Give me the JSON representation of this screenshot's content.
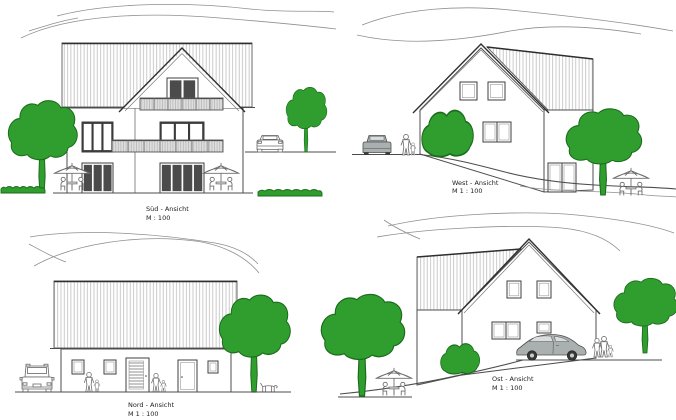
{
  "views": [
    {
      "id": "sued",
      "title": "Süd - Ansicht",
      "scale_label": "M : 100"
    },
    {
      "id": "west",
      "title": "West - Ansicht",
      "scale_label": "M 1 : 100"
    },
    {
      "id": "nord",
      "title": "Nord - Ansicht",
      "scale_label": "M 1 : 100"
    },
    {
      "id": "ost",
      "title": "Ost - Ansicht",
      "scale_label": "M 1 : 100"
    }
  ],
  "colors": {
    "background": "#ffffff",
    "line": "#4d4d4d",
    "roof_hatch": "#bdbdbd",
    "foliage_green": "#2f9e2f",
    "foliage_outline": "#1a6b1a",
    "car_gray": "#aab0b0",
    "glass_dark": "#4b4b4b"
  }
}
